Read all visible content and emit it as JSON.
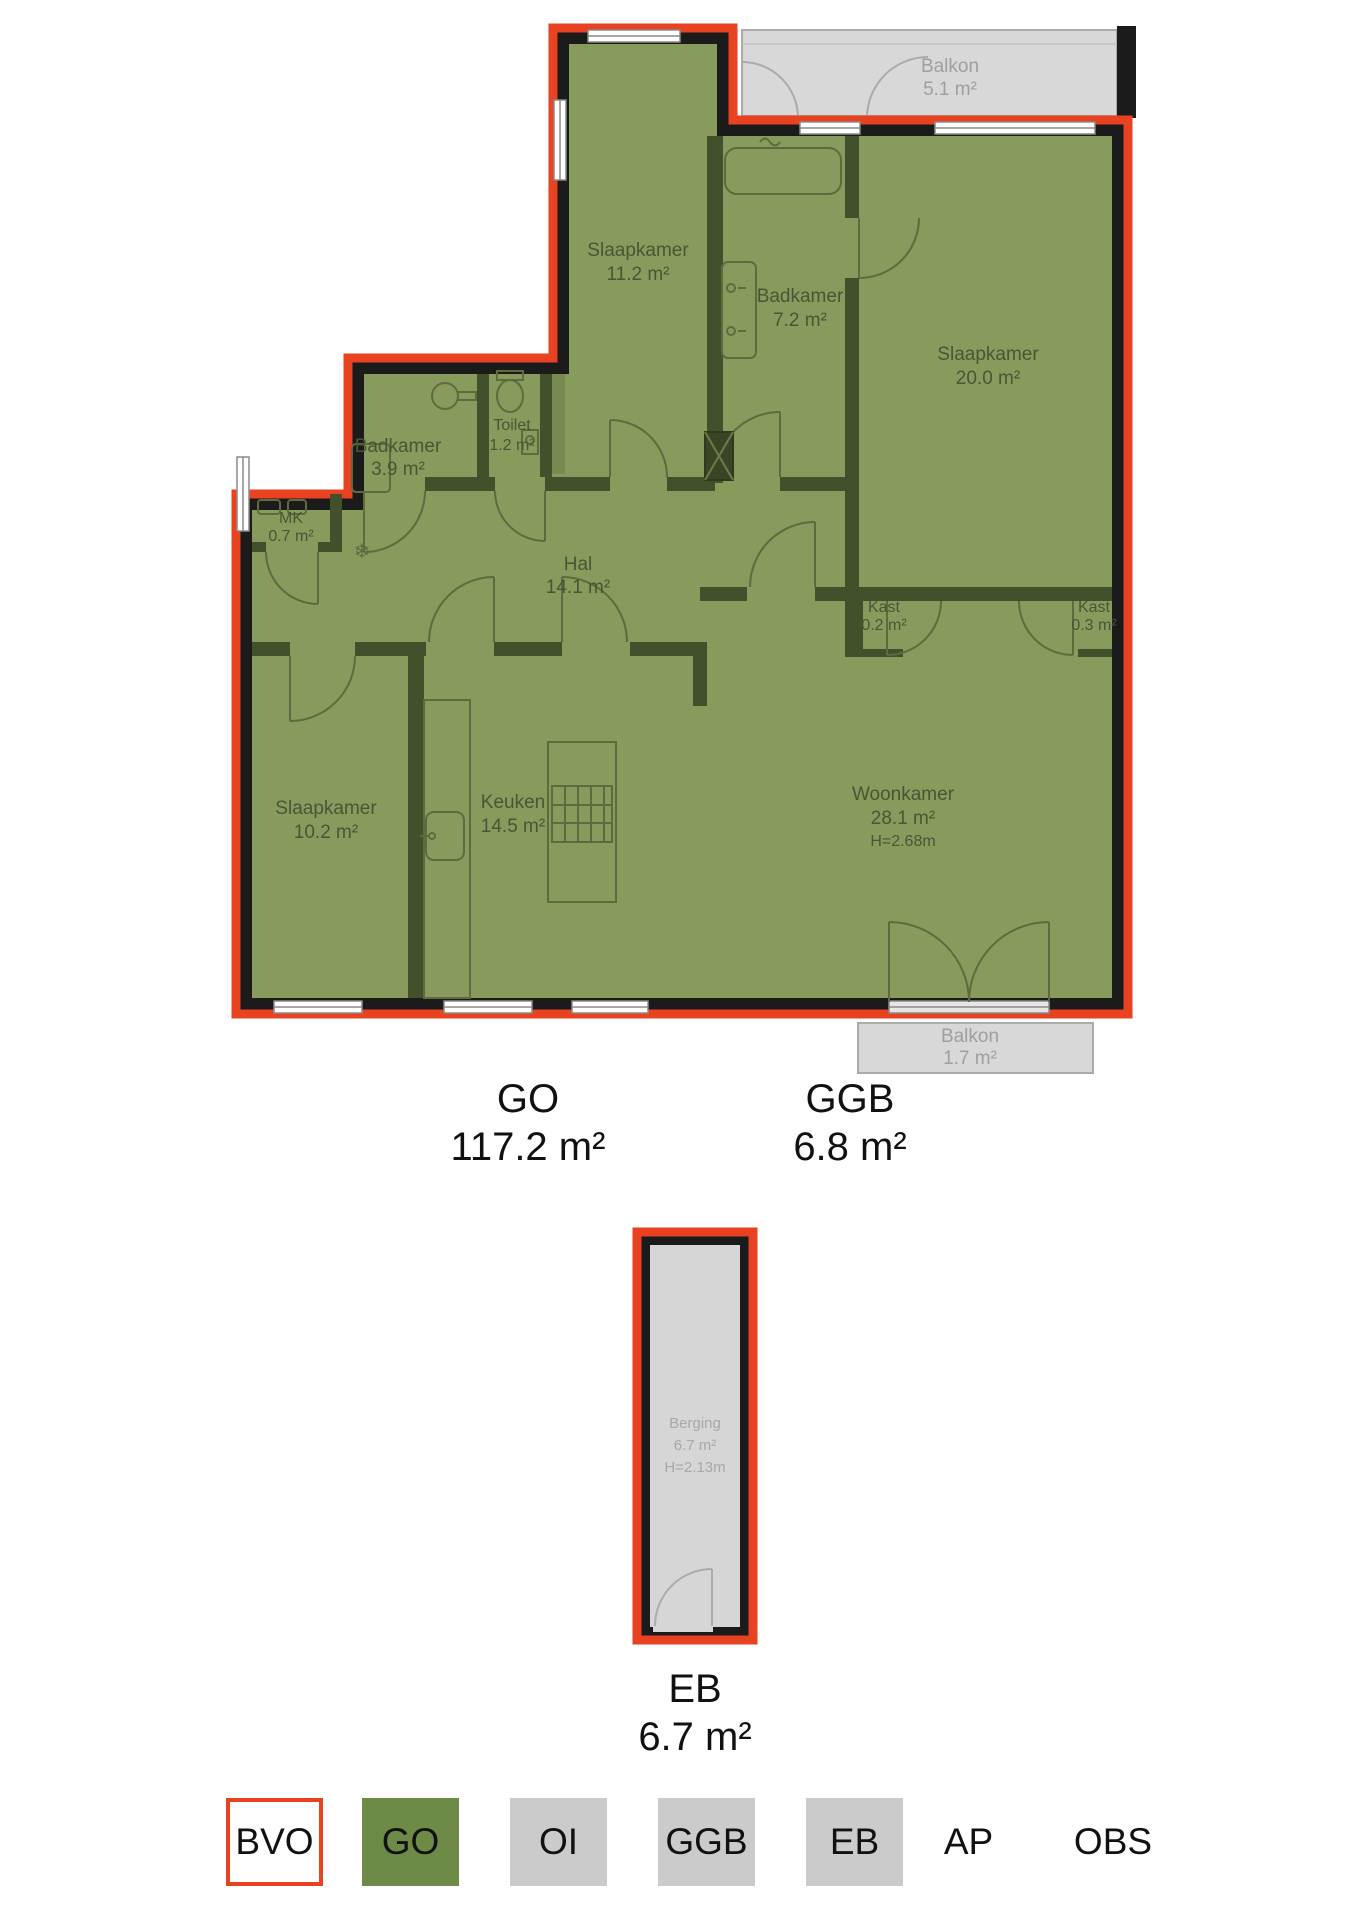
{
  "plan": {
    "rooms": {
      "slaapkamer_1": {
        "name": "Slaapkamer",
        "area": "11.2 m²"
      },
      "badkamer_1": {
        "name": "Badkamer",
        "area": "7.2 m²"
      },
      "slaapkamer_2": {
        "name": "Slaapkamer",
        "area": "20.0 m²"
      },
      "badkamer_2": {
        "name": "Badkamer",
        "area": "3.9 m²"
      },
      "toilet": {
        "name": "Toilet",
        "area": "1.2 m²"
      },
      "mk": {
        "name": "MK",
        "area": "0.7 m²"
      },
      "hal": {
        "name": "Hal",
        "area": "14.1 m²"
      },
      "kast_1": {
        "name": "Kast",
        "area": "0.2 m²"
      },
      "kast_2": {
        "name": "Kast",
        "area": "0.3 m²"
      },
      "slaapkamer_3": {
        "name": "Slaapkamer",
        "area": "10.2 m²"
      },
      "keuken": {
        "name": "Keuken",
        "area": "14.5 m²"
      },
      "woonkamer": {
        "name": "Woonkamer",
        "area": "28.1 m²",
        "ceiling_height": "H=2.68m"
      },
      "balkon_1": {
        "name": "Balkon",
        "area": "5.1 m²"
      },
      "balkon_2": {
        "name": "Balkon",
        "area": "1.7 m²"
      },
      "berging": {
        "name": "Berging",
        "area": "6.7 m²",
        "ceiling_height": "H=2.13m"
      }
    },
    "summary": {
      "go": {
        "label": "GO",
        "area": "117.2 m²"
      },
      "ggb": {
        "label": "GGB",
        "area": "6.8 m²"
      },
      "eb": {
        "label": "EB",
        "area": "6.7 m²"
      }
    },
    "legend": [
      {
        "code": "BVO"
      },
      {
        "code": "GO"
      },
      {
        "code": "OI"
      },
      {
        "code": "GGB"
      },
      {
        "code": "EB"
      },
      {
        "code": "AP"
      },
      {
        "code": "OBS"
      }
    ],
    "colors": {
      "bvo_outline": "#e84220",
      "go_fill": "#879b5c",
      "go_legend_fill": "#6d8a46",
      "balcony_fill": "#d8d8d8",
      "legend_gray_fill": "#cbcbcb",
      "wall_outer": "#1b1b1b",
      "wall_inner": "#42502b"
    }
  }
}
